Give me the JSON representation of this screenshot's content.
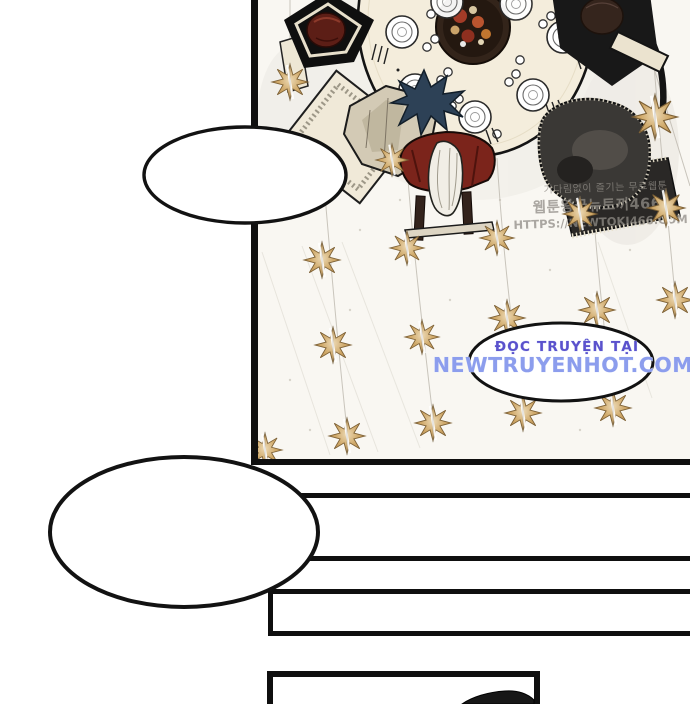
{
  "page": {
    "background": "#ffffff"
  },
  "watermarks": {
    "korean": {
      "line1": "기다림없이 즐기는 무료웹툰",
      "line2": "웹툰왕국뉴토끼466,",
      "line3": "HTTPS://NEWTOKI466.COM",
      "color": "#908c86"
    },
    "vietnamese": {
      "line1": "ĐỌC TRUYỆN TẠI",
      "line2": "NEWTRUYENHOT.COM",
      "color_line1": "#5a51cc",
      "color_line2": "#8c9ded"
    }
  },
  "speech_bubbles": [
    {
      "id": "bubble-top-left",
      "text": ""
    },
    {
      "id": "bubble-middle-right",
      "text": ""
    },
    {
      "id": "bubble-bottom-left",
      "text": ""
    }
  ],
  "colors": {
    "panel_border": "#0f0f0f",
    "panel_bg": "#f9f7f2",
    "star_gold": "#cfa868",
    "table": "#f4eddc",
    "bubble_fill": "#ffffff",
    "bubble_stroke": "#121212"
  }
}
